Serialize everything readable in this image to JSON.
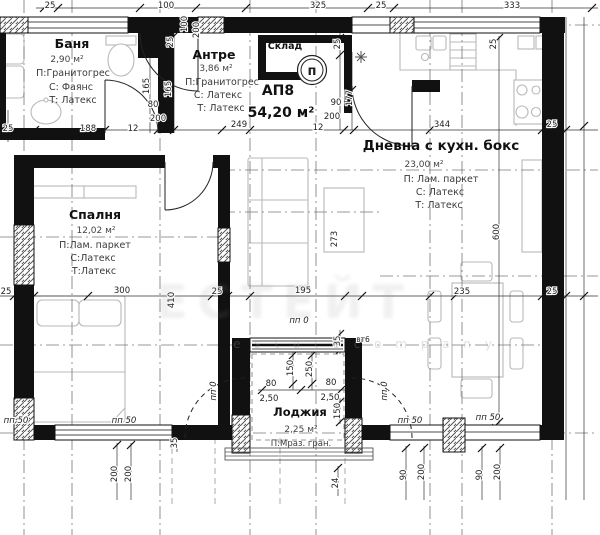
{
  "plan": {
    "apartment_code": "АП8",
    "apartment_area": "54,20 м²",
    "rooms": [
      {
        "name": "Баня",
        "area": "2,90 м²",
        "floor": "П:Гранитогрес",
        "walls": "С: Фаянс",
        "ceiling": "Т: Латекс"
      },
      {
        "name": "Антре",
        "area": "3,86 м²",
        "floor": "П:Гранитогрес",
        "walls": "С: Латекс",
        "ceiling": "Т: Латекс"
      },
      {
        "name": "Склад",
        "area": "",
        "floor": "",
        "walls": "",
        "ceiling": ""
      },
      {
        "name": "Дневна с кухн. бокс",
        "area": "23,00 м²",
        "floor": "П: Лам. паркет",
        "walls": "С: Латекс",
        "ceiling": "Т: Латекс"
      },
      {
        "name": "Спалня",
        "area": "12,02 м²",
        "floor": "П:Лам. паркет",
        "walls": "С:Латекс",
        "ceiling": "Т:Латекс"
      },
      {
        "name": "Лоджия",
        "area": "2,25 м²",
        "floor": "П:Мраз. гран.",
        "walls": "",
        "ceiling": ""
      }
    ],
    "symbols": {
      "boiler": "п"
    },
    "dims": {
      "top_row": [
        "25",
        "100",
        "325",
        "25",
        "333"
      ],
      "entry_vertical": [
        "100",
        "200",
        "25",
        "165",
        "165"
      ],
      "upper_right_vertical": [
        "25",
        "177",
        "25"
      ],
      "bath_door": [
        "80",
        "200",
        "12",
        "188",
        "25"
      ],
      "living_door": [
        "90",
        "200",
        "12"
      ],
      "mid_row": [
        "249",
        "344",
        "25"
      ],
      "axis_row": [
        "25",
        "300",
        "410",
        "25",
        "195",
        "235",
        "25"
      ],
      "interior_vertical": [
        "273",
        "600"
      ],
      "loggia_top": [
        "35",
        "вт6"
      ],
      "loggia_inner": [
        "150",
        "250",
        "80",
        "80",
        "2,50",
        "2,50",
        "150"
      ],
      "pp": [
        "пп 50",
        "пп 50",
        "пп 50",
        "пп 50",
        "пп 0",
        "пп 0",
        "пп 0"
      ],
      "bottom": [
        "200",
        "200",
        "35",
        "90",
        "200",
        "90",
        "200",
        "24"
      ]
    },
    "watermark": {
      "big": "ЕСТЕЙТ",
      "small": "e s t a t e   c o m p a n y"
    },
    "colors": {
      "wall": "#111111",
      "dimline": "#333333",
      "axis": "#666666",
      "furniture": "#b8b8b8"
    }
  }
}
